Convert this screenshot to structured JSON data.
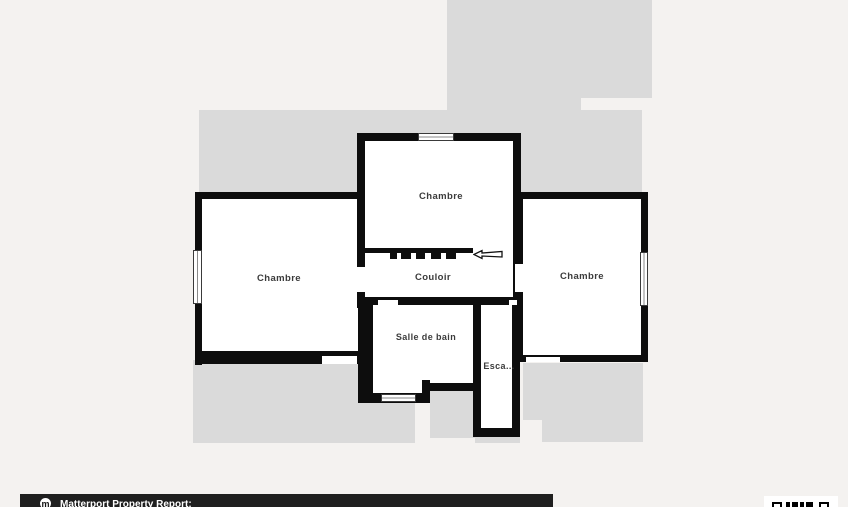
{
  "floorplan": {
    "rooms": [
      {
        "id": "chambre-top",
        "label": "Chambre"
      },
      {
        "id": "chambre-left",
        "label": "Chambre"
      },
      {
        "id": "chambre-right",
        "label": "Chambre"
      },
      {
        "id": "couloir",
        "label": "Couloir"
      },
      {
        "id": "salle-de-bain",
        "label": "Salle de bain"
      },
      {
        "id": "escalier",
        "label": "Esca..."
      }
    ],
    "icons": [
      "entrance-arrow-icon",
      "window-symbol",
      "door-opening"
    ],
    "colors": {
      "background": "#f4f2f0",
      "footprint_shadow": "#dadada",
      "wall": "#0d0d0d",
      "room_fill": "#ffffff",
      "label_text": "#3b3b3b"
    }
  },
  "footer": {
    "report_label": "Matterport Property Report:",
    "logo_glyph": "m",
    "bar_color": "#1f1f1f",
    "icons": [
      "matterport-logo-icon",
      "qr-code-icon"
    ]
  }
}
